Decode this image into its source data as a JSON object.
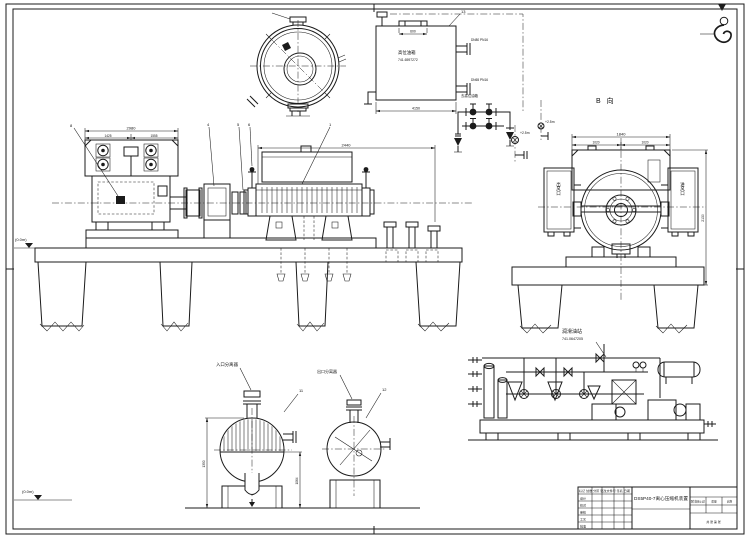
{
  "view": {
    "b_label": "B 向"
  },
  "equipment": {
    "oil_tank_name": "高位油箱",
    "oil_tank_code": "741.6597272",
    "inlet_separator": "入口分离器",
    "outlet_separator": "出口分离器",
    "oil_station_name": "润滑油站",
    "oil_station_code": "741.0647205",
    "to_tank_note": "去高位油箱",
    "cooler_left_text": "出风口",
    "cooler_right_text": "进风口",
    "tank_nozzle_1": "DN80 PN16",
    "tank_nozzle_2": "DN65 PN16"
  },
  "levels": {
    "ground_mid": "(0.0m)",
    "ground_bottom": "(0.0m)",
    "elev_a": "+2.5m",
    "elev_b": "+2.5m"
  },
  "dims": {
    "motor_width": "2980",
    "motor_seg_a": "1425",
    "motor_seg_b": "1555",
    "compressor_len": "2440",
    "viewb_width": "1840",
    "viewb_half_a": "1020",
    "viewb_half_b": "1020",
    "viewb_height": "2130",
    "tank_len": "4150",
    "tank_manhole": "600",
    "sep_height": "1350",
    "sep_dia": "1064"
  },
  "callouts": {
    "c1": "1",
    "c4": "4",
    "c5": "5",
    "c6": "6",
    "c8": "8",
    "c11": "11",
    "c12": "12",
    "c13": "13"
  },
  "title_block": {
    "title": "DS5P40-7离心压缩机装置",
    "rev_header": "标记 处数 分区 更改文件号 签名 日期",
    "r1": "设计",
    "r2": "校对",
    "r3": "审核",
    "r4": "工艺",
    "r5": "批准",
    "stage": "阶段标记",
    "weight": "质量",
    "scale": "比例",
    "sheet": "共 张 第 张"
  }
}
